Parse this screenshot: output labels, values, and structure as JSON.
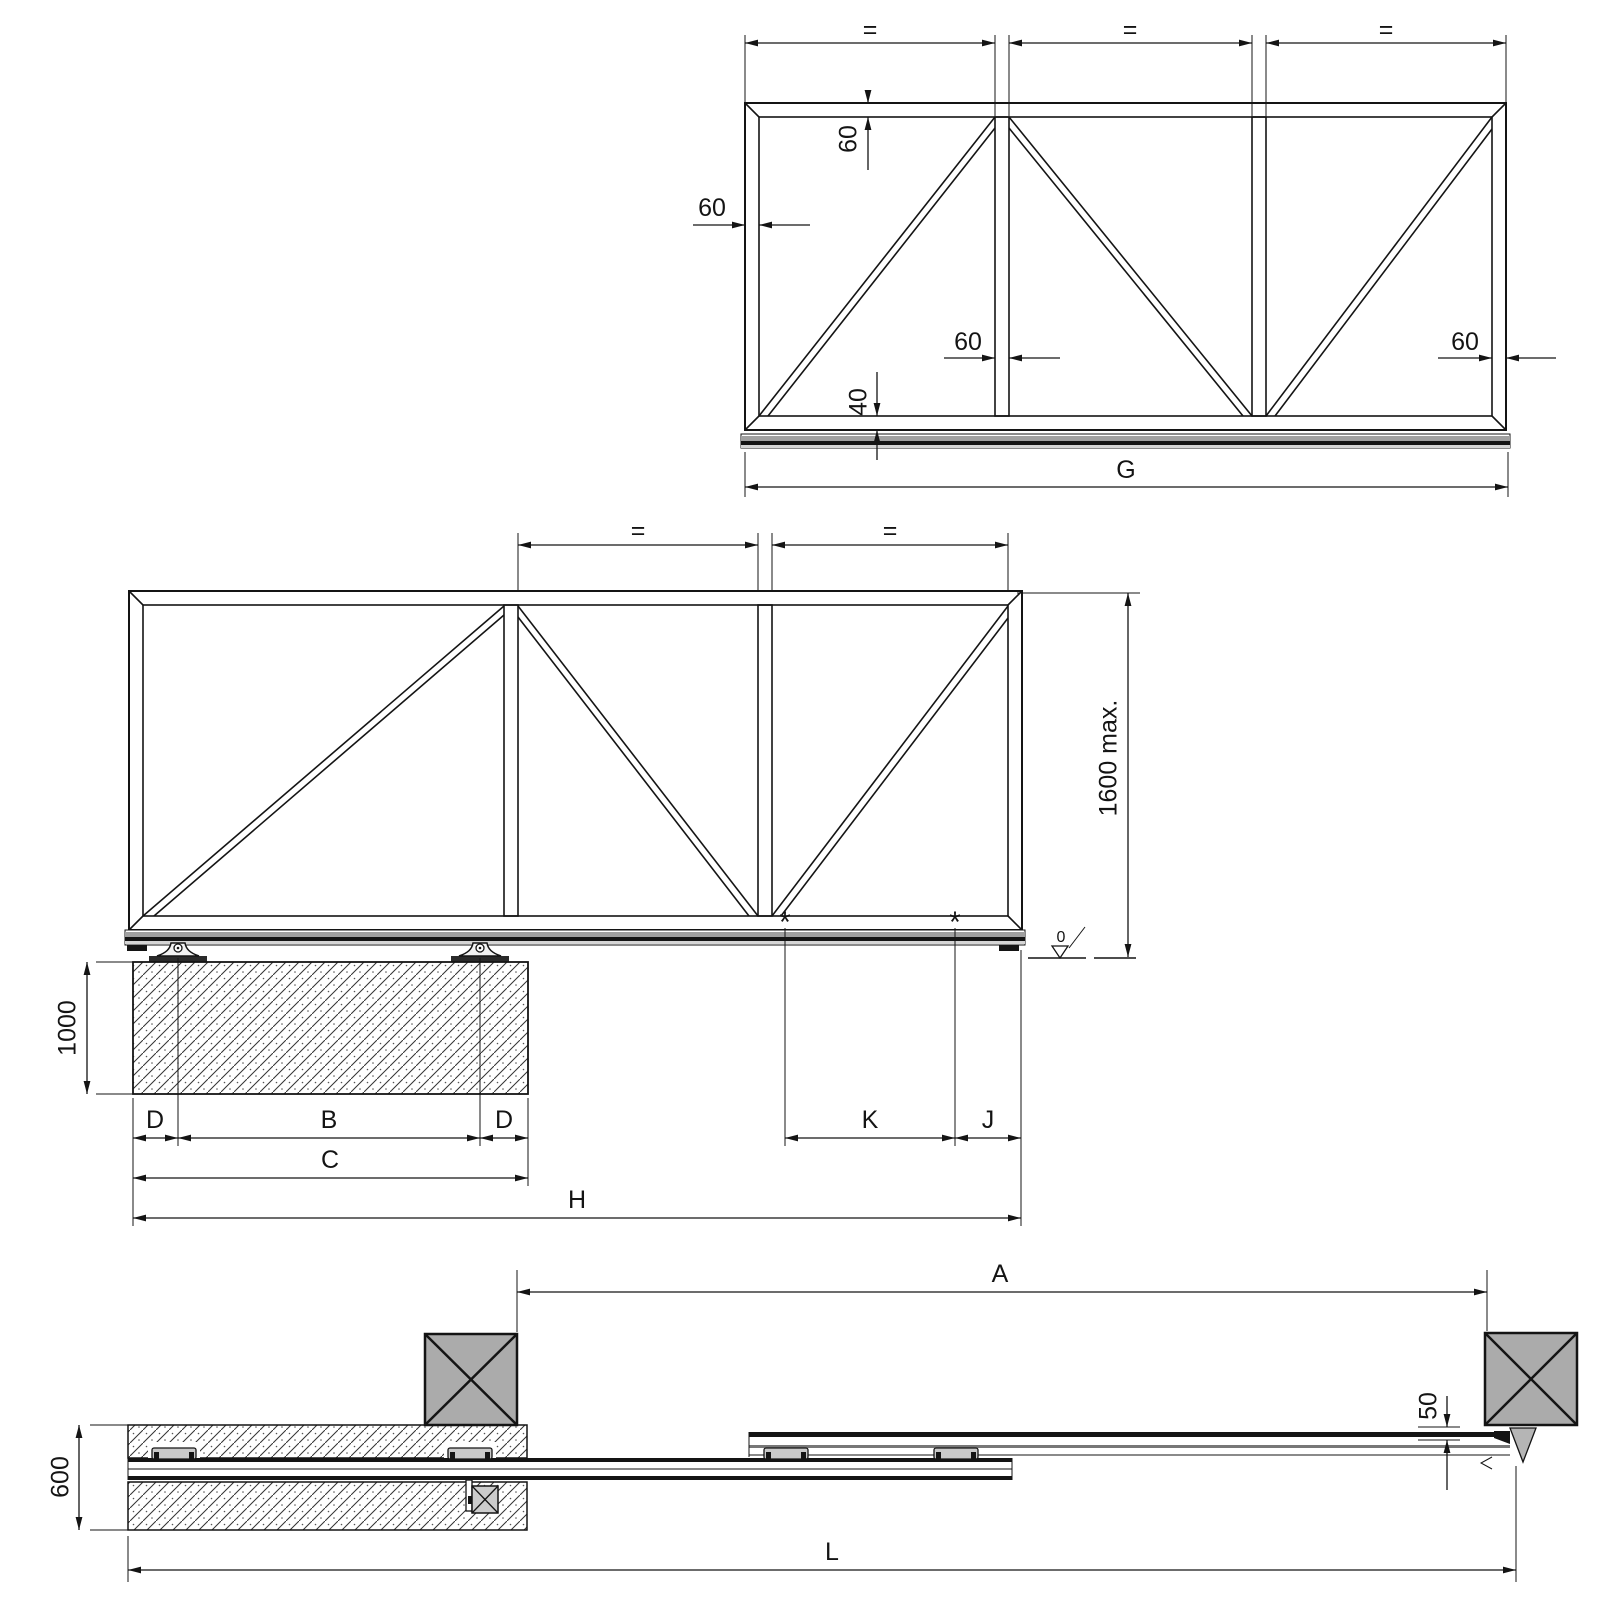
{
  "colors": {
    "line": "#141414",
    "post_fill": "#ababab",
    "rail_dark": "#141414",
    "rail_gray": "#a0a0a0",
    "rail_light": "#d5d5d5",
    "clip_fill": "#c9c9c9",
    "catch_fill": "#b5b5b5",
    "motor_fill": "#cccccc",
    "plate_fill": "#2a2a2a",
    "carriage_fill": "#f2f2f2"
  },
  "top_view": {
    "eq_spans": [
      "=",
      "=",
      "="
    ],
    "dim_top_member": "60",
    "dim_left_member": "60",
    "dim_post": "60",
    "dim_right_member": "60",
    "dim_bottom_member": "40",
    "dim_overall_width": "G"
  },
  "middle_view": {
    "eq_spans": [
      "=",
      "="
    ],
    "dim_gate_height": "1600 max.",
    "dim_foundation_depth": "1000",
    "dim_rear_offset": "D",
    "dim_carriage_spacing": "B",
    "dim_front_offset": "D",
    "dim_foundation_length": "C",
    "dim_overall_length": "H",
    "dim_cantilever": "K",
    "dim_nose": "J",
    "datum_level": "0",
    "support_marks": [
      "*",
      "*"
    ]
  },
  "bottom_view": {
    "dim_opening": "A",
    "dim_total_length": "L",
    "dim_foundation_width": "600",
    "dim_post_gap": "50"
  }
}
